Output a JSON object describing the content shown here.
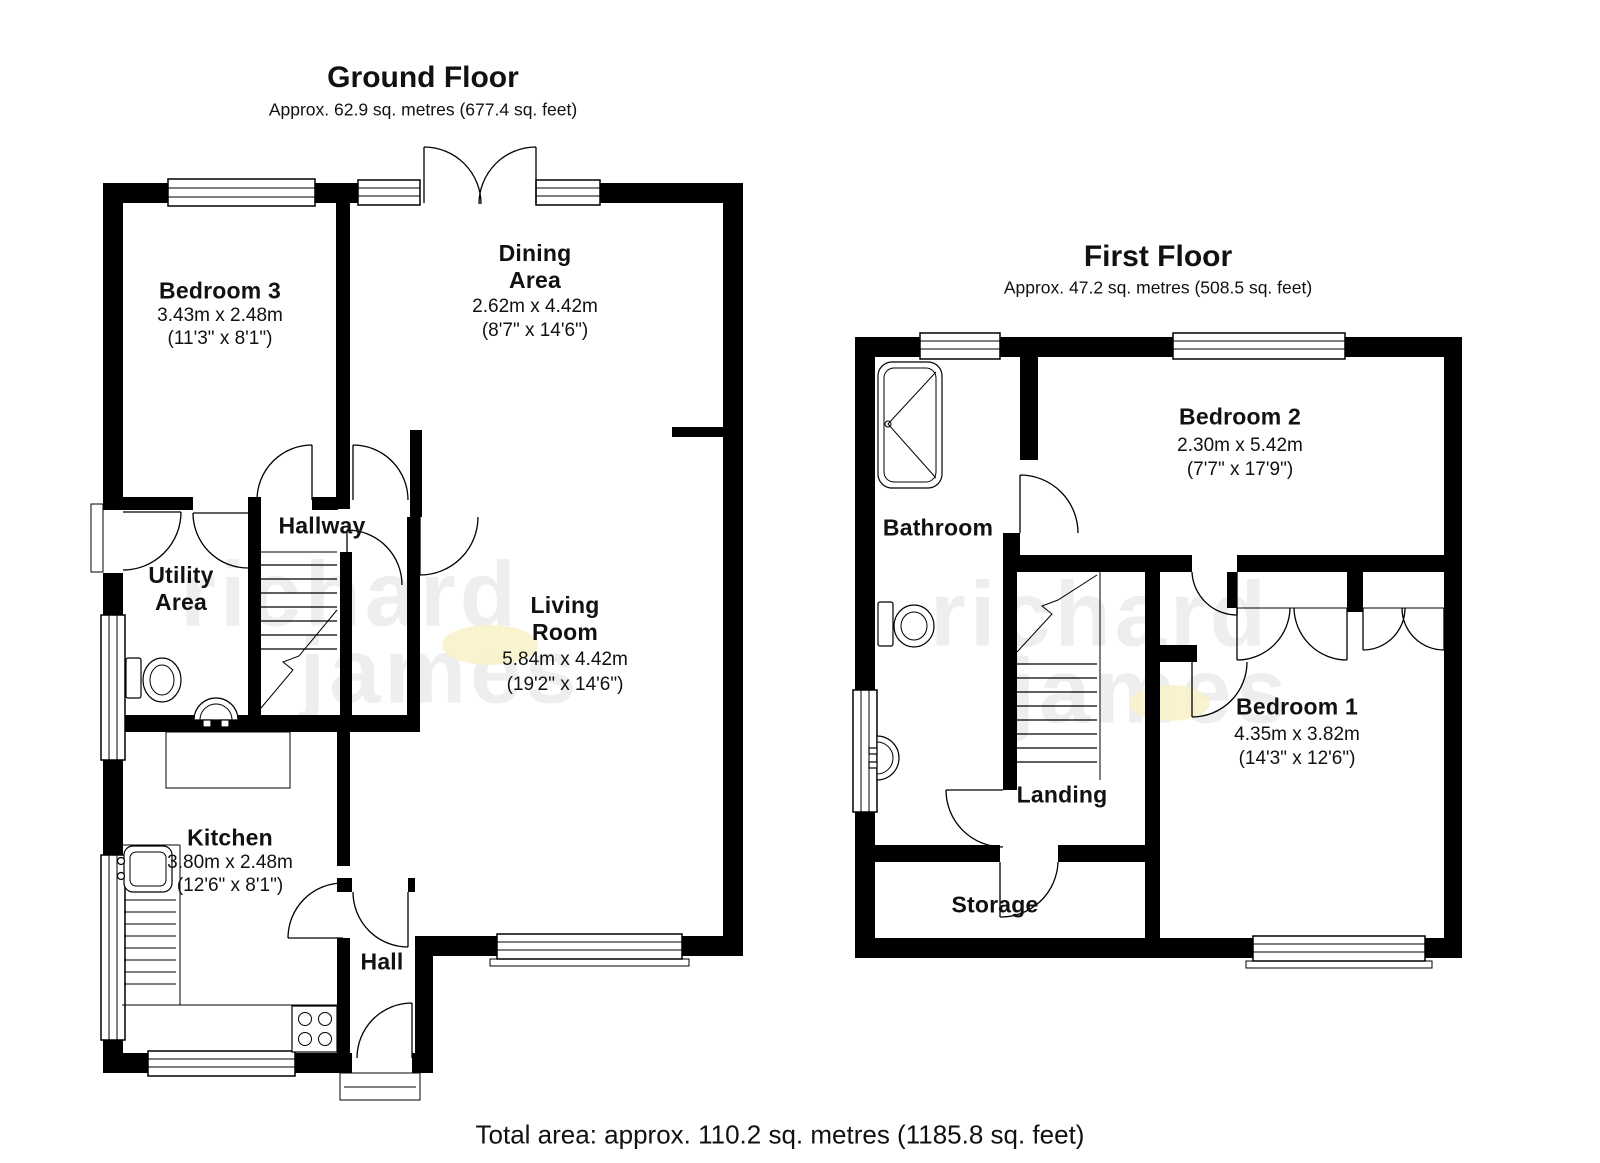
{
  "ground": {
    "title": "Ground Floor",
    "subtitle": "Approx. 62.9 sq. metres (677.4 sq. feet)",
    "rooms": {
      "bedroom3": {
        "name": "Bedroom 3",
        "metric": "3.43m x 2.48m",
        "imperial": "(11'3\" x 8'1\")"
      },
      "dining": {
        "name": "Dining Area",
        "metric": "2.62m x 4.42m",
        "imperial": "(8'7\" x 14'6\")"
      },
      "hallway": {
        "name": "Hallway"
      },
      "utility": {
        "name": "Utility Area"
      },
      "living": {
        "name": "Living Room",
        "metric": "5.84m x 4.42m",
        "imperial": "(19'2\" x 14'6\")"
      },
      "kitchen": {
        "name": "Kitchen",
        "metric": "3.80m x 2.48m",
        "imperial": "(12'6\" x 8'1\")"
      },
      "hall": {
        "name": "Hall"
      }
    }
  },
  "first": {
    "title": "First Floor",
    "subtitle": "Approx. 47.2 sq. metres (508.5 sq. feet)",
    "rooms": {
      "bathroom": {
        "name": "Bathroom"
      },
      "bedroom2": {
        "name": "Bedroom 2",
        "metric": "2.30m x 5.42m",
        "imperial": "(7'7\" x 17'9\")"
      },
      "bedroom1": {
        "name": "Bedroom 1",
        "metric": "4.35m x 3.82m",
        "imperial": "(14'3\" x 12'6\")"
      },
      "landing": {
        "name": "Landing"
      },
      "storage": {
        "name": "Storage"
      }
    }
  },
  "footer": {
    "total_area": "Total area: approx. 110.2 sq. metres (1185.8 sq. feet)"
  },
  "watermark": {
    "line1": "richard",
    "line2": "james"
  },
  "colors": {
    "wall": "#000000",
    "line": "#000000",
    "highlight": "#f9f1c8"
  }
}
